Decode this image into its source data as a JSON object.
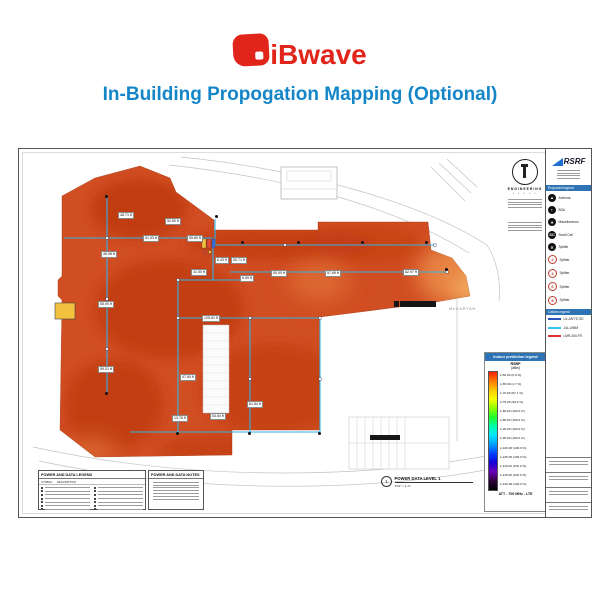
{
  "header": {
    "brand": "iBwave",
    "title": "In-Building Propogation Mapping (Optional)",
    "brand_color": "#e1251b",
    "title_color": "#1486c8"
  },
  "titleblock": {
    "firm": "RSRF",
    "proposed_legend_title": "Proposed legend",
    "legend_items": [
      {
        "icon": "antenna",
        "style": "black",
        "glyph": "▲",
        "label": "Antenna"
      },
      {
        "icon": "bda",
        "style": "black",
        "glyph": "◗",
        "label": "BDA"
      },
      {
        "icon": "miscellaneous",
        "style": "black",
        "glyph": "✶",
        "label": "Miscellaneous"
      },
      {
        "icon": "small-cell",
        "style": "black",
        "glyph": "SC",
        "label": "Small Cell"
      },
      {
        "icon": "splitter",
        "style": "black",
        "glyph": "✕",
        "label": "Splitter"
      },
      {
        "icon": "splitter-2",
        "style": "red",
        "glyph": "2",
        "label": "Splitter"
      },
      {
        "icon": "splitter-4",
        "style": "red",
        "glyph": "4",
        "label": "Splitter"
      },
      {
        "icon": "splitter-6",
        "style": "red",
        "glyph": "6",
        "label": "Splitter"
      },
      {
        "icon": "splitter-8",
        "style": "red",
        "glyph": "8",
        "label": "Splitter"
      }
    ],
    "cables_legend_title": "Cables legend",
    "cables": [
      {
        "label": "UL-ANT'S OD",
        "color": "#2a52be"
      },
      {
        "label": "J/A-10MM",
        "color": "#35c4f0"
      },
      {
        "label": "LMR-400-FR",
        "color": "#e03131"
      }
    ]
  },
  "prediction_legend": {
    "title": "Indoor prediction legend",
    "metric": "RSRP",
    "unit": "[dBm]",
    "entries": [
      "≥-60.00 (0.0 %)",
      "≥-65.00 (1.7 %)",
      "≥-70.00 (87.1 %)",
      "≥-75.00 (99.9 %)",
      "≥-80.00 (100.0 %)",
      "≥-85.00 (100.0 %)",
      "≥-90.00 (100.0 %)",
      "≥-95.00 (100.0 %)",
      "≥-100.00 (100.0 %)",
      "≥-105.00 (100.0 %)",
      "≥-110.00 (100.0 %)",
      "≥-115.00 (100.0 %)",
      "≥-120.00 (100.0 %)"
    ],
    "footer": "ATT - 700 MHz - LTE",
    "gradient": [
      "#ff1e00",
      "#ff7a00",
      "#ffc800",
      "#f8ff00",
      "#8cff00",
      "#1fff2a",
      "#00ffb0",
      "#00e4ff",
      "#009cff",
      "#0040ff",
      "#1500d6",
      "#6a00b8",
      "#30003a",
      "#000000"
    ]
  },
  "plan": {
    "street_label": "McCARTAN",
    "stamp_name": "ENGINEERING",
    "heat_base_color": "#d14e22",
    "cable_color": "#2fb3e8",
    "measurements": [
      {
        "text": "48.71 ft",
        "x": 99,
        "y": 63
      },
      {
        "text": "52.80 ft",
        "x": 146,
        "y": 69
      },
      {
        "text": "51.53 ft",
        "x": 124,
        "y": 86
      },
      {
        "text": "55.80 ft",
        "x": 168,
        "y": 86
      },
      {
        "text": "46.98 ft",
        "x": 82,
        "y": 102
      },
      {
        "text": "6.43 ft",
        "x": 196,
        "y": 108
      },
      {
        "text": "50.71 ft",
        "x": 212,
        "y": 108
      },
      {
        "text": "41.50 ft",
        "x": 172,
        "y": 120
      },
      {
        "text": "6.59 ft",
        "x": 221,
        "y": 126
      },
      {
        "text": "55.50 ft",
        "x": 252,
        "y": 121
      },
      {
        "text": "57.89 ft",
        "x": 306,
        "y": 121
      },
      {
        "text": "62.97 ft",
        "x": 384,
        "y": 120
      },
      {
        "text": "55.90 ft",
        "x": 79,
        "y": 152
      },
      {
        "text": "125.81 ft",
        "x": 183,
        "y": 166
      },
      {
        "text": "59.01 ft",
        "x": 79,
        "y": 217
      },
      {
        "text": "47.80 ft",
        "x": 161,
        "y": 225
      },
      {
        "text": "61.84 ft",
        "x": 228,
        "y": 252
      },
      {
        "text": "13.76 ft",
        "x": 153,
        "y": 266
      },
      {
        "text": "53.84 ft",
        "x": 191,
        "y": 264
      }
    ],
    "callout": {
      "number": "1",
      "title": "POWER DATA LEVEL 1",
      "scale": "3/32\" = 1'-0\""
    }
  },
  "power_legend_box": {
    "title": "POWER AND DATA LEGEND",
    "col_symbol": "SYMBOL",
    "col_desc": "DESCRIPTION"
  },
  "notes_box": {
    "title": "POWER AND DATA NOTES"
  }
}
